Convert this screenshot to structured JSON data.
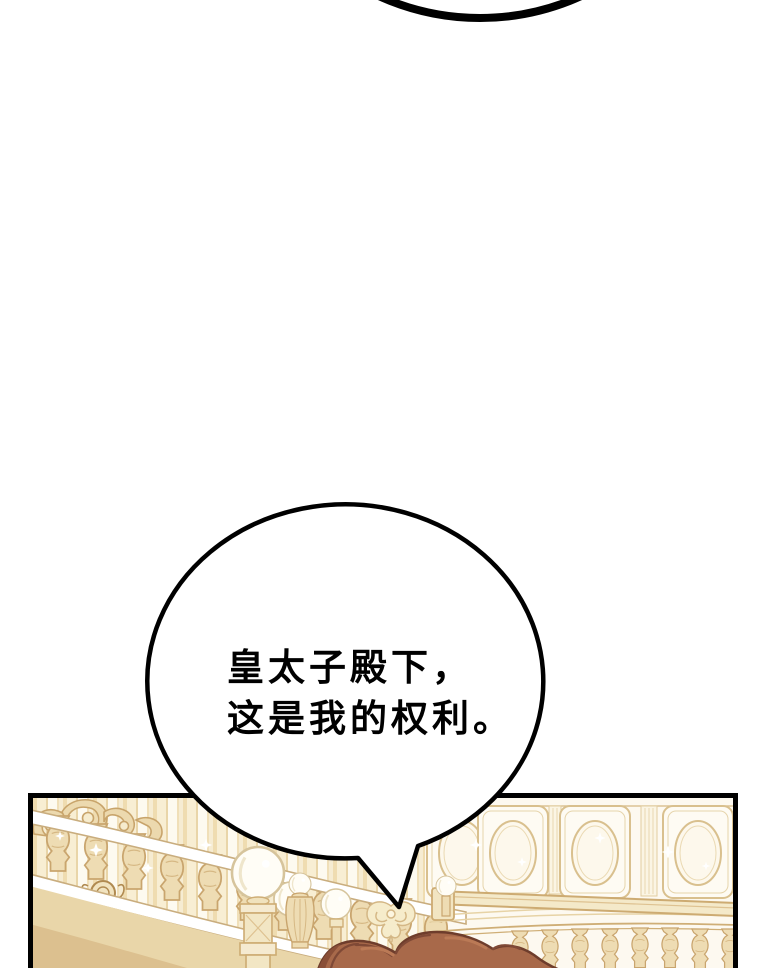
{
  "page": {
    "background": "#ffffff",
    "kind_label": "webtoon comic page"
  },
  "previous_bubble_arc": {
    "color": "#000000"
  },
  "speech_bubble": {
    "fill": "#ffffff",
    "outline": "#000000",
    "text_color": "#000000",
    "lines": {
      "line1": "皇太子殿下，",
      "line2": "这是我的权利。"
    }
  },
  "panel": {
    "border_color": "#000000",
    "scene_label": "palace hall with curved balustrade, globe lamps and paneled wall",
    "palette": {
      "panel_bg": "#fdf8ec",
      "stripe_cream": "#f8eed3",
      "stripe_gold": "#e9d5a8",
      "line_tan": "#cdab72",
      "line_tan_light": "#e2cda0",
      "baluster_fill": "#eedcb3",
      "rail_white": "#ffffff",
      "globe_fill": "#fffdf6",
      "cornice_fill": "#f4e9c9",
      "stringer_fill": "#e9d6a9"
    },
    "character_hair": {
      "base": "#a8694a",
      "shadow": "#7f4936",
      "dark_wedge": "#8a4f38",
      "outline": "#6e3d2c",
      "highlight": "#bb7a56"
    }
  }
}
